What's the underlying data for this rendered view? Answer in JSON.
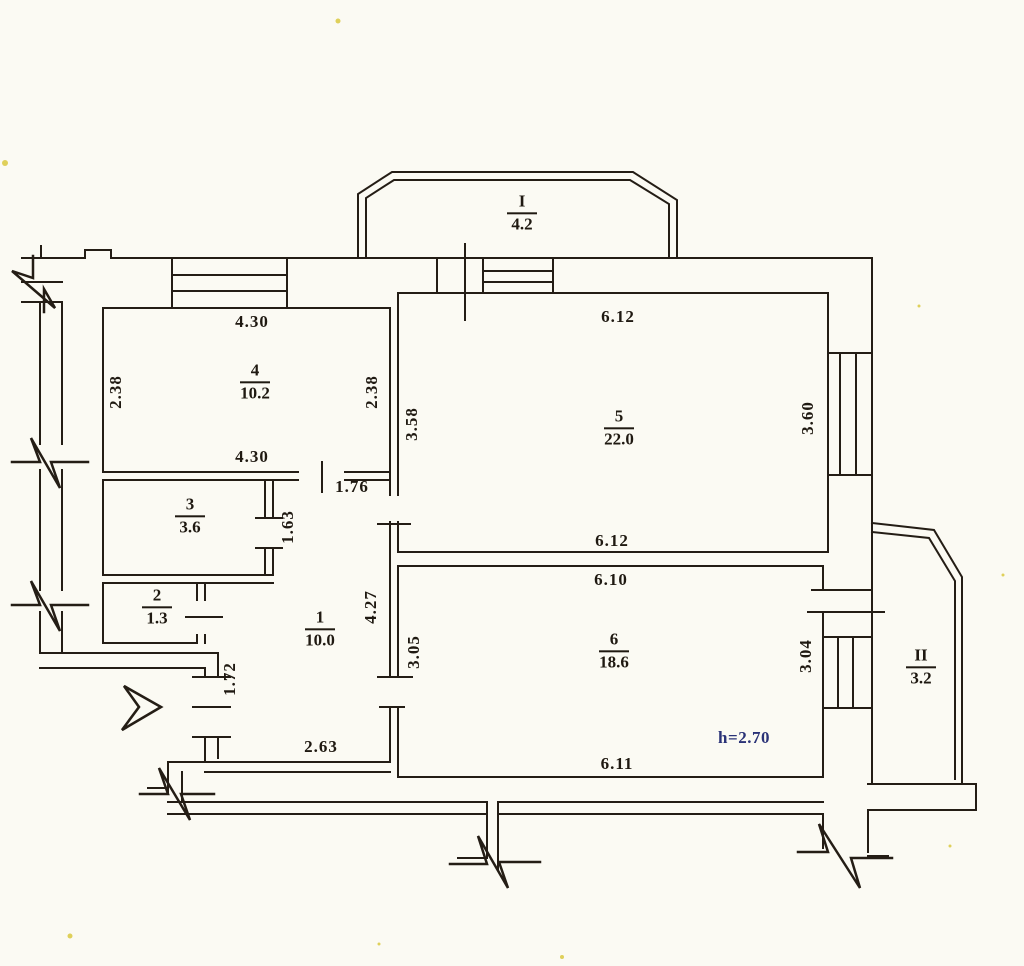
{
  "plan": {
    "type": "apartment-floor-plan",
    "units": "m",
    "rooms": [
      {
        "number": "1",
        "area": "10.0"
      },
      {
        "number": "2",
        "area": "1.3"
      },
      {
        "number": "3",
        "area": "3.6"
      },
      {
        "number": "4",
        "area": "10.2"
      },
      {
        "number": "5",
        "area": "22.0"
      },
      {
        "number": "6",
        "area": "18.6"
      }
    ],
    "balconies": [
      {
        "number": "I",
        "area": "4.2"
      },
      {
        "number": "II",
        "area": "3.2"
      }
    ],
    "dimensions": {
      "room4": {
        "top": "4.30",
        "left": "2.38",
        "right": "2.38",
        "bottom": "4.30"
      },
      "room5": {
        "top": "6.12",
        "left": "3.58",
        "right": "3.60",
        "bottom": "6.12"
      },
      "room6": {
        "top": "6.10",
        "left": "3.05",
        "right": "3.04",
        "bottom": "6.11"
      },
      "hall": {
        "top": "1.76",
        "closet": "1.63",
        "right": "4.27",
        "entry": "1.72",
        "bottom": "2.63"
      }
    },
    "ceiling_height": "h=2.70",
    "colors": {
      "ink": "#241d15",
      "height_note": "#2a3277",
      "paper": "#fbfaf3"
    }
  }
}
